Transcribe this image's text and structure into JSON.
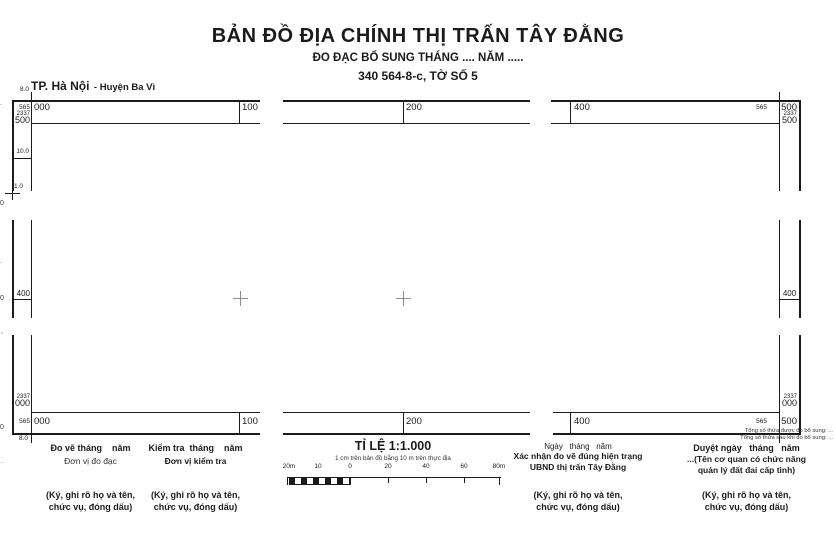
{
  "header": {
    "title": "BẢN ĐỒ ĐỊA CHÍNH THỊ TRẤN TÂY ĐẰNG",
    "subtitle": "ĐO ĐẠC BỔ SUNG THÁNG .... NĂM .....",
    "sheet_info": "340 564-8-c, TỜ SỐ 5",
    "province": "TP. Hà Nội",
    "district": "- Huyện Ba Vì"
  },
  "frame": {
    "dim_top": "8.0",
    "dim_left": "10.0",
    "dim_inner": "1.0",
    "dim_bottom": "8.0",
    "tl": {
      "e_pre": "565",
      "e_val": "000",
      "n_pre": "2337",
      "n_val": "500"
    },
    "tr": {
      "e_pre": "565",
      "e_val": "500",
      "n_pre": "2337",
      "n_val": "500"
    },
    "bl": {
      "e_pre": "565",
      "e_val": "000",
      "n_pre": "2337",
      "n_val": "000"
    },
    "br": {
      "e_pre": "565",
      "e_val": "500",
      "n_pre": "2337",
      "n_val": "000"
    },
    "top_ticks": [
      "100",
      "200",
      "400"
    ],
    "bottom_ticks": [
      "100",
      "200",
      "400"
    ],
    "left_tick": "400",
    "right_tick": "400",
    "edge_fragments": [
      ".",
      "0",
      ".",
      "0",
      ",",
      "0",
      "."
    ]
  },
  "scale": {
    "title": "TỈ LỆ 1:1.000",
    "note": "1 cm trên bản đồ bằng 10 m trên thực địa",
    "bar_labels": [
      "20m",
      "10",
      "0",
      "20",
      "40",
      "60",
      "80m"
    ]
  },
  "blocks": {
    "survey": {
      "l1": "Đo vẽ tháng    năm",
      "l2": "Đơn vị đo đạc",
      "s1": "(Ký, ghi rõ họ và tên,",
      "s2": "chức vụ, đóng dấu)"
    },
    "inspect": {
      "l1": "Kiểm tra  tháng    năm",
      "l2": "Đơn vị kiểm tra",
      "s1": "(Ký, ghi rõ họ và tên,",
      "s2": "chức vụ, đóng dấu)"
    },
    "confirm": {
      "l1": "Ngày   tháng   năm",
      "l2": "Xác nhận đo vẽ đúng hiện trạng",
      "l3": "UBND thị trấn Tây Đằng",
      "s1": "(Ký, ghi rõ họ và tên,",
      "s2": "chức vụ, đóng dấu)"
    },
    "approve": {
      "n1": "Tổng số thửa được đo bổ sung: ...",
      "n2": "Tổng số thửa sau khi đo bổ sung: ...",
      "l1": "Duyệt ngày   tháng   năm",
      "l2": "...(Tên cơ quan có chức năng",
      "l3": "quản lý đất đai cấp tỉnh)",
      "s1": "(Ký, ghi rõ họ và tên,",
      "s2": "chức vụ, đóng dấu)"
    }
  }
}
